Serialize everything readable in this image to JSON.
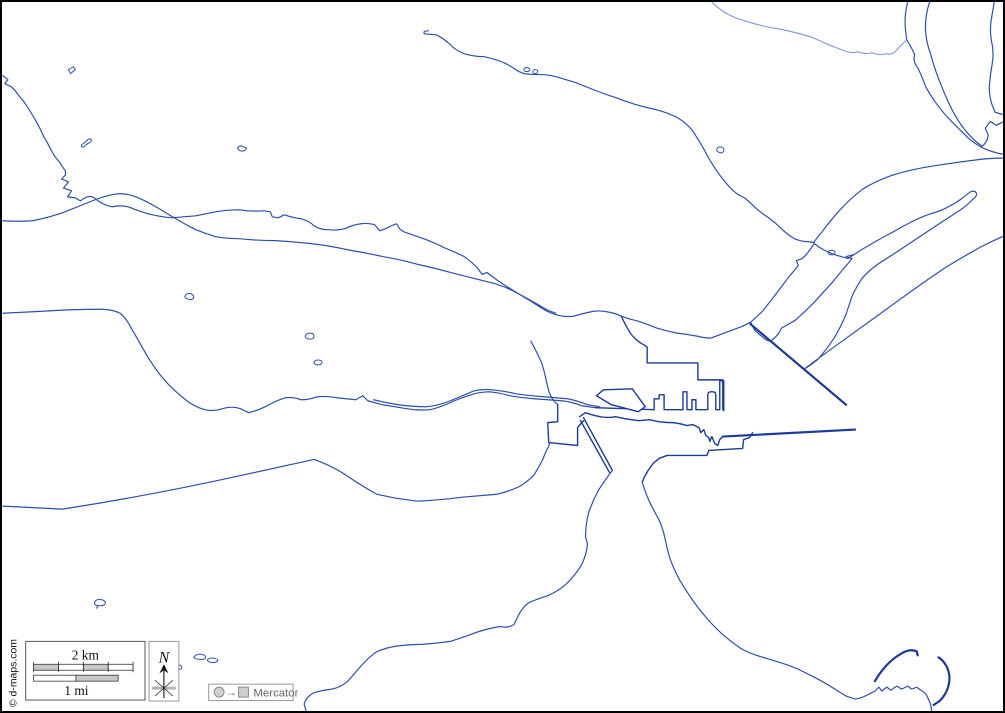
{
  "map": {
    "attribution": "© d-maps.com",
    "legend": {
      "scale_km_label": "2 km",
      "scale_mi_label": "1 mi",
      "compass_label": "N",
      "projection_label": "Mercator",
      "projection_arrow": "→"
    },
    "colors": {
      "coastline": "#2d4fa9",
      "coastline_light": "#7b97d6",
      "coastline_dark": "#1c3a97",
      "frame": "#000000",
      "scale_bar_gray": "#c9c9c9",
      "background": "#ffffff"
    }
  }
}
